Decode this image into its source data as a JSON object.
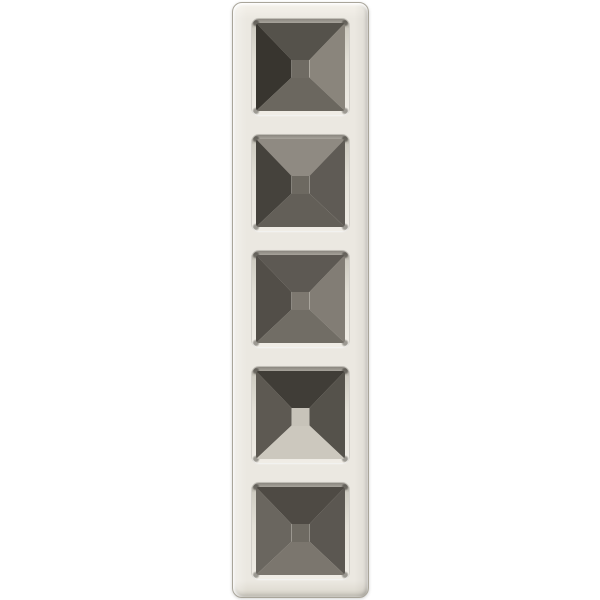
{
  "page": {
    "background": "#ffffff"
  },
  "colors": {
    "page_background": "#ffffff",
    "frame_face": "#ebe8e1",
    "frame_face_light": "#f5f2eb",
    "frame_face_dark": "#d9d5ca",
    "frame_outline": "#a9a59a",
    "recess_shadow": "#8b8780",
    "recess_mid": "#cfccc2",
    "recess_light": "#f0ede6"
  },
  "product": {
    "opening_count": 5,
    "openings": [
      {
        "facets": {
          "top": "#55524b",
          "left": "#38352f",
          "right": "#8a857c",
          "bottom": "#6b675f",
          "center": "#6f6b63"
        }
      },
      {
        "facets": {
          "top": "#8f8a82",
          "left": "#45423c",
          "right": "#5f5b55",
          "bottom": "#635f58",
          "center": "#6d6961"
        }
      },
      {
        "facets": {
          "top": "#5d5953",
          "left": "#524e48",
          "right": "#827d75",
          "bottom": "#716d65",
          "center": "#7d7870"
        }
      },
      {
        "facets": {
          "top": "#403d37",
          "left": "#5d5952",
          "right": "#55524b",
          "bottom": "#ccc8be",
          "center": "#c7c3b9"
        }
      },
      {
        "facets": {
          "top": "#4e4a44",
          "left": "#6a665f",
          "right": "#5b5751",
          "bottom": "#7b766e",
          "center": "#6e6a62"
        }
      }
    ]
  }
}
